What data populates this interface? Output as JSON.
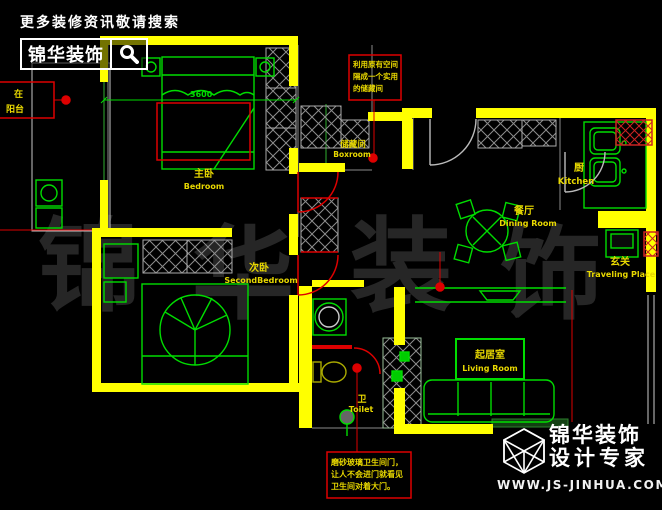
{
  "header": {
    "tagline": "更多装修资讯敬请搜索",
    "brand": "锦华装饰"
  },
  "footer": {
    "brand_top": "锦华装饰",
    "brand_bottom": "设计专家",
    "website": "WWW.JS-JINHUA.COM"
  },
  "watermark": {
    "c0": "锦",
    "c1": "华",
    "c2": "装",
    "c3": "饰"
  },
  "rooms": {
    "master": {
      "zh": "主卧",
      "en": "Bedroom"
    },
    "second": {
      "zh": "次卧",
      "en": "SecondBedroom"
    },
    "storage": {
      "zh": "储藏间",
      "en": "Boxroom"
    },
    "kitchen": {
      "zh": "厨",
      "en": "Kitchen"
    },
    "dining": {
      "zh": "餐厅",
      "en": "Dining Room"
    },
    "entry": {
      "zh": "玄关",
      "en": "Traveling Place"
    },
    "living": {
      "zh": "起居室",
      "en": "Living Room"
    },
    "toilet": {
      "zh": "卫",
      "en": "Toilet"
    }
  },
  "notes": {
    "storage": {
      "l1": "利用原有空间",
      "l2": "隔成一个实用",
      "l3": "的储藏间"
    },
    "bath": {
      "l1": "磨砂玻璃卫生间门，",
      "l2": "让人不会进门就看见",
      "l3": "卫生间对着大门。"
    },
    "left": {
      "l1": "在",
      "l2": "阳台"
    }
  },
  "dimensions": {
    "bed_width": "3600"
  },
  "colors": {
    "wall": "#ffff00",
    "furniture": "#00dd00",
    "annotation": "#dd0000",
    "label_text": "#e8d800",
    "watermark": "#262626",
    "brand_text": "#ffffff"
  }
}
